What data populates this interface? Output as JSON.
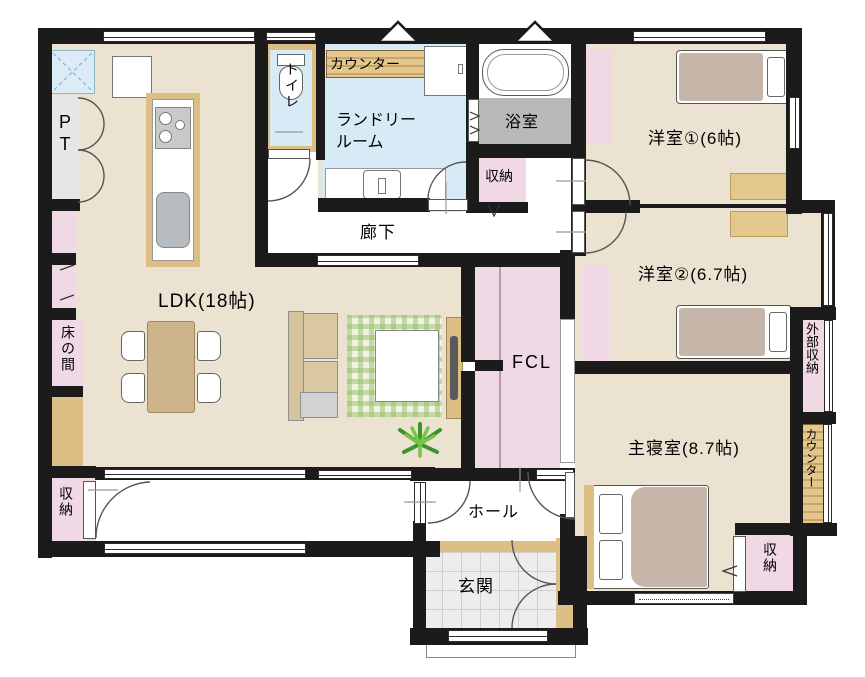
{
  "labels": {
    "ldk": "LDK(18帖)",
    "pantry": "PT",
    "toilet": "トイレ",
    "laundry_counter": "カウンター",
    "laundry_line1": "ランドリー",
    "laundry_line2": "ルーム",
    "bath": "浴室",
    "storage_bath": "収納",
    "hallway": "廊下",
    "room1": "洋室①(6帖)",
    "room2": "洋室②(6.7帖)",
    "tokonoma": "床の間",
    "fcl": "FCL",
    "external_storage": "外部収納",
    "counter_right": "カウンター",
    "master": "主寝室(8.7帖)",
    "hall": "ホール",
    "genkan": "玄関",
    "storage_sw": "収納",
    "storage_master": "収納"
  },
  "colors": {
    "wall": "#1b1b1b",
    "room_floor": "#ebe2d2",
    "wet_floor": "#d7ebf7",
    "closet_pink": "#f0d9e5",
    "wood_counter": "#ddbe85",
    "bath_gray": "#b9b9b9",
    "rug_green": "#dfe9c8",
    "bed_blanket": "#c6b6a9",
    "plant_green": "#4ba327"
  }
}
